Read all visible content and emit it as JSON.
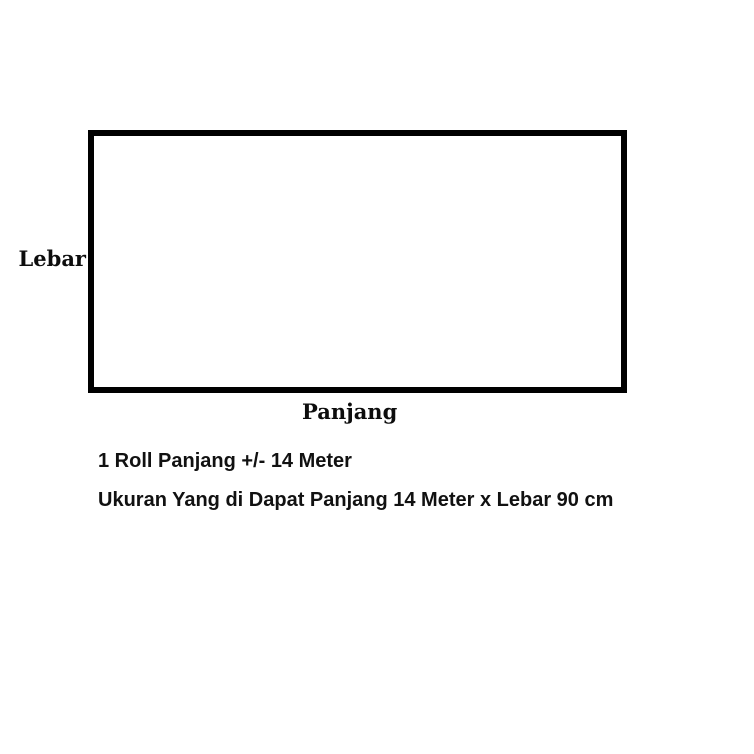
{
  "diagram": {
    "shape": "rectangle",
    "labels": {
      "width": "Lebar",
      "length": "Panjang"
    }
  },
  "notes": {
    "line1": "1 Roll Panjang +/- 14 Meter",
    "line2": "Ukuran Yang di Dapat Panjang 14 Meter x Lebar 90 cm"
  },
  "colors": {
    "background": "#ffffff",
    "rect_border": "#000000",
    "text": "#111111"
  }
}
